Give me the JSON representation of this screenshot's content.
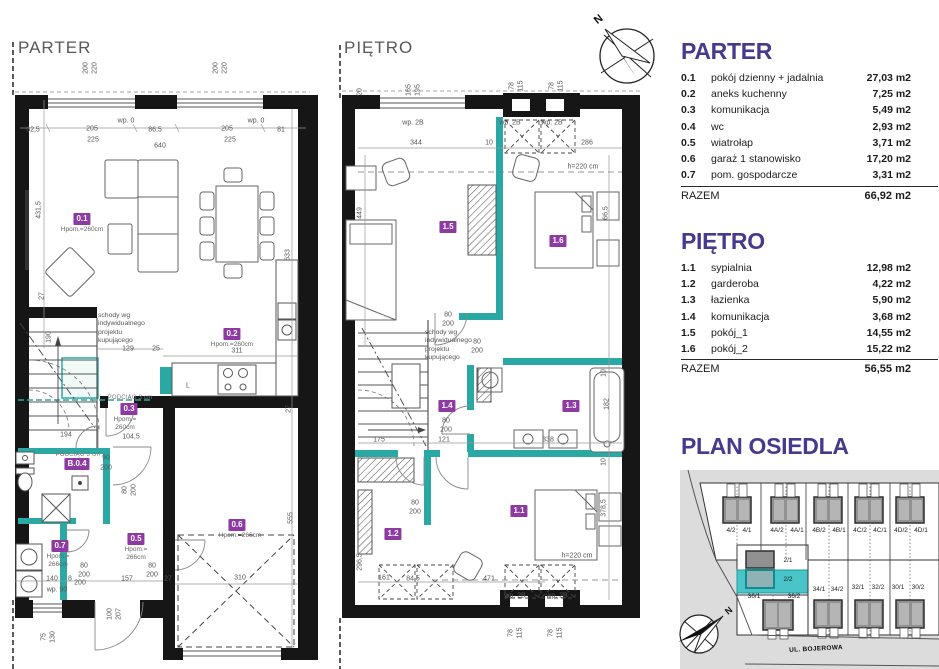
{
  "colors": {
    "accent_purple": "#463a8d",
    "badge_purple": "#8e3aa3",
    "teal": "#2aa9a4",
    "teal_highlight": "#49c5c9"
  },
  "plans": {
    "parter": {
      "title": "PARTER",
      "stairs_note": "schody wg\nindywidualnego\nprojektu\nkupującego",
      "badges": [
        {
          "id": "0.1",
          "x": 82,
          "y": 219,
          "note": "Hpom.=260cm",
          "nx": 82,
          "ny": 226
        },
        {
          "id": "0.2",
          "x": 232,
          "y": 334,
          "note": "Hpom.=260cm",
          "nx": 232,
          "ny": 341
        },
        {
          "id": "0.3",
          "x": 129,
          "y": 409,
          "note": "Hpom.=\n260cm",
          "nx": 125,
          "ny": 416
        },
        {
          "id": "B.0.4",
          "x": 77,
          "y": 464
        },
        {
          "id": "0.5",
          "x": 136,
          "y": 539,
          "note": "Hpom.=\n266cm",
          "nx": 136,
          "ny": 546
        },
        {
          "id": "0.6",
          "x": 237,
          "y": 525,
          "note": "Hpom.=266cm",
          "nx": 240,
          "ny": 532
        },
        {
          "id": "0.7",
          "x": 60,
          "y": 546,
          "note": "Hpom.=\n266cm",
          "nx": 58,
          "ny": 553
        }
      ],
      "dims": [
        {
          "t": "200",
          "x": 86,
          "y": 68,
          "r": -90
        },
        {
          "t": "220",
          "x": 95,
          "y": 68,
          "r": -90
        },
        {
          "t": "200",
          "x": 216,
          "y": 68,
          "r": -90
        },
        {
          "t": "220",
          "x": 225,
          "y": 68,
          "r": -90
        },
        {
          "t": "wp. 0",
          "x": 126,
          "y": 121
        },
        {
          "t": "wp. 0",
          "x": 256,
          "y": 121
        },
        {
          "t": "62,5",
          "x": 33,
          "y": 130
        },
        {
          "t": "205",
          "x": 92,
          "y": 129
        },
        {
          "t": "225",
          "x": 93,
          "y": 140
        },
        {
          "t": "86,5",
          "x": 155,
          "y": 130
        },
        {
          "t": "205",
          "x": 227,
          "y": 129
        },
        {
          "t": "225",
          "x": 230,
          "y": 140
        },
        {
          "t": "81",
          "x": 281,
          "y": 130
        },
        {
          "t": "640",
          "x": 160,
          "y": 146
        },
        {
          "t": "431,5",
          "x": 39,
          "y": 210,
          "r": -90
        },
        {
          "t": "633",
          "x": 288,
          "y": 255,
          "r": -90
        },
        {
          "t": "27",
          "x": 42,
          "y": 296,
          "r": -90
        },
        {
          "t": "190",
          "x": 49,
          "y": 337,
          "r": -90
        },
        {
          "t": "129",
          "x": 128,
          "y": 349
        },
        {
          "t": "25",
          "x": 156,
          "y": 349
        },
        {
          "t": "311",
          "x": 237,
          "y": 351
        },
        {
          "t": "L",
          "x": 188,
          "y": 386
        },
        {
          "t": "PODCIĄG 3 cm",
          "x": 130,
          "y": 398,
          "cls": "beam"
        },
        {
          "t": "PODCIĄG 3 cm",
          "x": 78,
          "y": 455,
          "cls": "beam"
        },
        {
          "t": "104,5",
          "x": 131,
          "y": 437
        },
        {
          "t": "194",
          "x": 66,
          "y": 435
        },
        {
          "t": "90",
          "x": 106,
          "y": 458
        },
        {
          "t": "200",
          "x": 106,
          "y": 468
        },
        {
          "t": "80",
          "x": 125,
          "y": 490,
          "r": -90
        },
        {
          "t": "200",
          "x": 134,
          "y": 490,
          "r": -90
        },
        {
          "t": "27",
          "x": 289,
          "y": 409,
          "r": -90
        },
        {
          "t": "555",
          "x": 291,
          "y": 518,
          "r": -90
        },
        {
          "t": "310",
          "x": 240,
          "y": 578
        },
        {
          "t": "80",
          "x": 84,
          "y": 566
        },
        {
          "t": "200",
          "x": 84,
          "y": 575
        },
        {
          "t": "140",
          "x": 52,
          "y": 579
        },
        {
          "t": "8",
          "x": 70,
          "y": 579
        },
        {
          "t": "200",
          "x": 80,
          "y": 583
        },
        {
          "t": "wp. 90",
          "x": 57,
          "y": 590
        },
        {
          "t": "157",
          "x": 127,
          "y": 579
        },
        {
          "t": "80",
          "x": 152,
          "y": 566
        },
        {
          "t": "200",
          "x": 152,
          "y": 575
        },
        {
          "t": "27",
          "x": 168,
          "y": 579
        },
        {
          "t": "100",
          "x": 110,
          "y": 614,
          "r": -90
        },
        {
          "t": "207",
          "x": 119,
          "y": 614,
          "r": -90
        },
        {
          "t": "75",
          "x": 44,
          "y": 637,
          "r": -90
        },
        {
          "t": "130",
          "x": 53,
          "y": 637,
          "r": -90
        }
      ],
      "note_x": 98,
      "note_y": 312
    },
    "pietro": {
      "title": "PIĘTRO",
      "stairs_note": "schody wg\nindywidualnego\nprojektu\nkupującego",
      "badges": [
        {
          "id": "1.5",
          "x": 448,
          "y": 227
        },
        {
          "id": "1.6",
          "x": 558,
          "y": 241
        },
        {
          "id": "1.4",
          "x": 447,
          "y": 406
        },
        {
          "id": "1.3",
          "x": 571,
          "y": 406
        },
        {
          "id": "1.2",
          "x": 393,
          "y": 534
        },
        {
          "id": "1.1",
          "x": 519,
          "y": 511
        }
      ],
      "dims": [
        {
          "t": "20",
          "x": 360,
          "y": 92,
          "r": -90
        },
        {
          "t": "165",
          "x": 409,
          "y": 90,
          "r": -90
        },
        {
          "t": "195",
          "x": 418,
          "y": 90,
          "r": -90
        },
        {
          "t": "78",
          "x": 512,
          "y": 86,
          "r": -90
        },
        {
          "t": "115",
          "x": 521,
          "y": 86,
          "r": -90
        },
        {
          "t": "78",
          "x": 552,
          "y": 86,
          "r": -90
        },
        {
          "t": "115",
          "x": 561,
          "y": 86,
          "r": -90
        },
        {
          "t": "wp. 2B",
          "x": 413,
          "y": 123
        },
        {
          "t": "wp. 2B",
          "x": 510,
          "y": 123
        },
        {
          "t": "wp. 2B",
          "x": 552,
          "y": 123
        },
        {
          "t": "344",
          "x": 416,
          "y": 143
        },
        {
          "t": "10",
          "x": 489,
          "y": 143
        },
        {
          "t": "286",
          "x": 587,
          "y": 143
        },
        {
          "t": "449",
          "x": 360,
          "y": 213,
          "r": -90
        },
        {
          "t": "66,5",
          "x": 606,
          "y": 213,
          "r": -90
        },
        {
          "t": "h=220 cm",
          "x": 583,
          "y": 167
        },
        {
          "t": "80",
          "x": 448,
          "y": 315
        },
        {
          "t": "200",
          "x": 448,
          "y": 324
        },
        {
          "t": "80",
          "x": 477,
          "y": 342
        },
        {
          "t": "200",
          "x": 477,
          "y": 351
        },
        {
          "t": "175",
          "x": 379,
          "y": 440
        },
        {
          "t": "121",
          "x": 444,
          "y": 440
        },
        {
          "t": "338",
          "x": 548,
          "y": 440
        },
        {
          "t": "80",
          "x": 446,
          "y": 421
        },
        {
          "t": "200",
          "x": 446,
          "y": 430
        },
        {
          "t": "182",
          "x": 607,
          "y": 404,
          "r": -90
        },
        {
          "t": "10",
          "x": 604,
          "y": 373,
          "r": -90
        },
        {
          "t": "10",
          "x": 604,
          "y": 462,
          "r": -90
        },
        {
          "t": "378,5",
          "x": 604,
          "y": 508,
          "r": -90
        },
        {
          "t": "80",
          "x": 415,
          "y": 503
        },
        {
          "t": "200",
          "x": 415,
          "y": 512
        },
        {
          "t": "296,5",
          "x": 360,
          "y": 562,
          "r": -90
        },
        {
          "t": "h=220 cm",
          "x": 577,
          "y": 556
        },
        {
          "t": "161",
          "x": 384,
          "y": 578
        },
        {
          "t": "84,5",
          "x": 413,
          "y": 579
        },
        {
          "t": "471",
          "x": 489,
          "y": 579
        },
        {
          "t": "wp. 2B",
          "x": 515,
          "y": 596
        },
        {
          "t": "wp. 2B",
          "x": 557,
          "y": 596
        },
        {
          "t": "78",
          "x": 511,
          "y": 633,
          "r": -90
        },
        {
          "t": "115",
          "x": 520,
          "y": 633,
          "r": -90
        },
        {
          "t": "78",
          "x": 551,
          "y": 633,
          "r": -90
        },
        {
          "t": "115",
          "x": 560,
          "y": 633,
          "r": -90
        }
      ],
      "note_x": 425,
      "note_y": 329
    }
  },
  "legend": {
    "parter": {
      "title": "PARTER",
      "rows": [
        {
          "id": "0.1",
          "name": "pokój dzienny + jadalnia",
          "area": "27,03 m2"
        },
        {
          "id": "0.2",
          "name": "aneks kuchenny",
          "area": "7,25 m2"
        },
        {
          "id": "0.3",
          "name": "komunikacja",
          "area": "5,49 m2"
        },
        {
          "id": "0.4",
          "name": "wc",
          "area": "2,93 m2"
        },
        {
          "id": "0.5",
          "name": "wiatrołap",
          "area": "3,71 m2"
        },
        {
          "id": "0.6",
          "name": "garaż 1 stanowisko",
          "area": "17,20 m2"
        },
        {
          "id": "0.7",
          "name": "pom. gospodarcze",
          "area": "3,31 m2"
        }
      ],
      "total_label": "RAZEM",
      "total": "66,92 m2"
    },
    "pietro": {
      "title": "PIĘTRO",
      "rows": [
        {
          "id": "1.1",
          "name": "sypialnia",
          "area": "12,98 m2"
        },
        {
          "id": "1.2",
          "name": "garderoba",
          "area": "4,22 m2"
        },
        {
          "id": "1.3",
          "name": "łazienka",
          "area": "5,90 m2"
        },
        {
          "id": "1.4",
          "name": "komunikacja",
          "area": "3,68 m2"
        },
        {
          "id": "1.5",
          "name": "pokój_1",
          "area": "14,55 m2"
        },
        {
          "id": "1.6",
          "name": "pokój_2",
          "area": "15,22 m2"
        }
      ],
      "total_label": "RAZEM",
      "total": "56,55 m2"
    }
  },
  "site_plan": {
    "title": "PLAN OSIEDLA",
    "street": "UL. BOJEROWA",
    "highlight_plot": "2/2",
    "labels": [
      {
        "t": "4/2",
        "x": 731,
        "y": 531
      },
      {
        "t": "4/1",
        "x": 747,
        "y": 531
      },
      {
        "t": "4A/2",
        "x": 777,
        "y": 531
      },
      {
        "t": "4A/1",
        "x": 797,
        "y": 531
      },
      {
        "t": "4B/2",
        "x": 819,
        "y": 531
      },
      {
        "t": "4B/1",
        "x": 839,
        "y": 531
      },
      {
        "t": "4C/2",
        "x": 860,
        "y": 531
      },
      {
        "t": "4C/1",
        "x": 880,
        "y": 531
      },
      {
        "t": "4D/2",
        "x": 901,
        "y": 531
      },
      {
        "t": "4D/1",
        "x": 921,
        "y": 531
      },
      {
        "t": "2/1",
        "x": 788,
        "y": 561
      },
      {
        "t": "2/2",
        "x": 788,
        "y": 580
      },
      {
        "t": "36/1",
        "x": 754,
        "y": 597
      },
      {
        "t": "36/2",
        "x": 794,
        "y": 597
      },
      {
        "t": "34/1",
        "x": 819,
        "y": 590
      },
      {
        "t": "34/2",
        "x": 837,
        "y": 590
      },
      {
        "t": "32/1",
        "x": 858,
        "y": 588
      },
      {
        "t": "32/2",
        "x": 878,
        "y": 588
      },
      {
        "t": "30/1",
        "x": 898,
        "y": 588
      },
      {
        "t": "30/2",
        "x": 918,
        "y": 588
      }
    ]
  },
  "compass": {
    "labels": [
      {
        "t": "N",
        "x": 599,
        "y": 20,
        "r": -38,
        "cls": "north",
        "n": "north-label"
      },
      {
        "t": "N",
        "x": 729,
        "y": 611,
        "r": -40,
        "cls": "north-sm",
        "n": "north-label"
      }
    ]
  }
}
